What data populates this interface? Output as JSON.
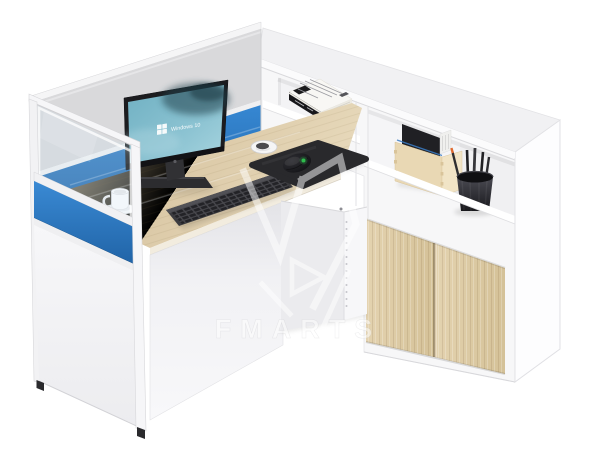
{
  "watermark": {
    "brand_text": "FMARTS"
  },
  "monitor": {
    "wallpaper_text": "Windows 10"
  },
  "palette": {
    "background": "#ffffff",
    "partition_blue": "#2b7ac4",
    "desk_wood": "#d8c7a4",
    "cabinet_door_wood": "#decda9",
    "plywood_box": "#e9d8b4",
    "frame_white": "#f5f5f6",
    "device_dark": "#2b2b2e",
    "mouse_accent_green": "#2fc24f",
    "pencil_accent_orange": "#e06a2e",
    "screen_teal": "#7fbccb"
  }
}
